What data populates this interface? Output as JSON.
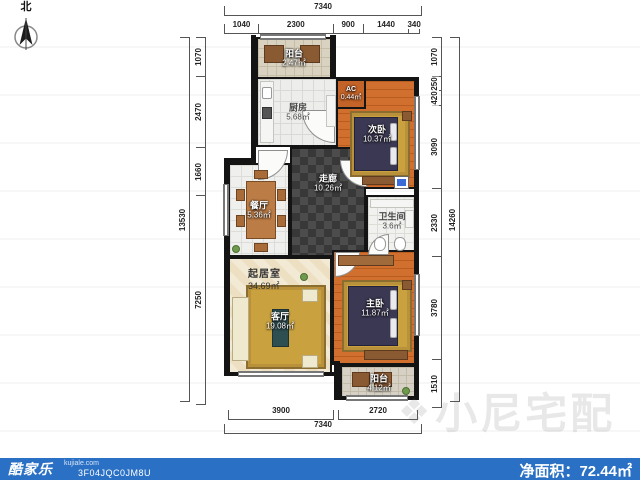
{
  "compass": {
    "label": "北"
  },
  "watermark": {
    "text": "小尼宅配"
  },
  "footer": {
    "logo": "酷家乐",
    "logo_sub": "kujiale.com",
    "plan_id": "3F04JQC0JM8U",
    "net_area_label": "净面积：",
    "net_area_value": "72.44㎡"
  },
  "colors": {
    "footer_bar": "#2a70c4",
    "walls": "#141414",
    "wood_floor": "#d06f2e",
    "rug_gold": "#c9a23f",
    "hallway_tile": "#3f3f3f",
    "balcony_tile": "#d9d2c2"
  },
  "rooms": {
    "balcony_top": {
      "name": "阳台",
      "area": "2.47㎡"
    },
    "kitchen": {
      "name": "厨房",
      "area": "5.68㎡"
    },
    "ac": {
      "name": "AC",
      "area": "0.44㎡"
    },
    "bedroom_second": {
      "name": "次卧",
      "area": "10.37㎡"
    },
    "hallway": {
      "name": "走廊",
      "area": "10.26㎡"
    },
    "bathroom": {
      "name": "卫生间",
      "area": "3.6㎡"
    },
    "dining": {
      "name": "餐厅",
      "area": "5.36㎡"
    },
    "living_quarters": {
      "name": "起居室",
      "area": "34.69㎡"
    },
    "living_room": {
      "name": "客厅",
      "area": "19.08㎡"
    },
    "bedroom_master": {
      "name": "主卧",
      "area": "11.87㎡"
    },
    "balcony_bottom": {
      "name": "阳台",
      "area": "4.12㎡"
    }
  },
  "dimensions": {
    "top": {
      "total": "7340",
      "segments": [
        "1040",
        "2300",
        "900",
        "1440",
        "340"
      ]
    },
    "bottom": {
      "total": "7340",
      "segments": [
        "3900",
        "2720"
      ]
    },
    "left": {
      "total": "13530",
      "segments": [
        "1070",
        "2470",
        "1660",
        "7250"
      ]
    },
    "right": {
      "total": "14260",
      "segments": [
        "1070",
        "250",
        "420",
        "3090",
        "2330",
        "3780",
        "1510"
      ]
    }
  }
}
